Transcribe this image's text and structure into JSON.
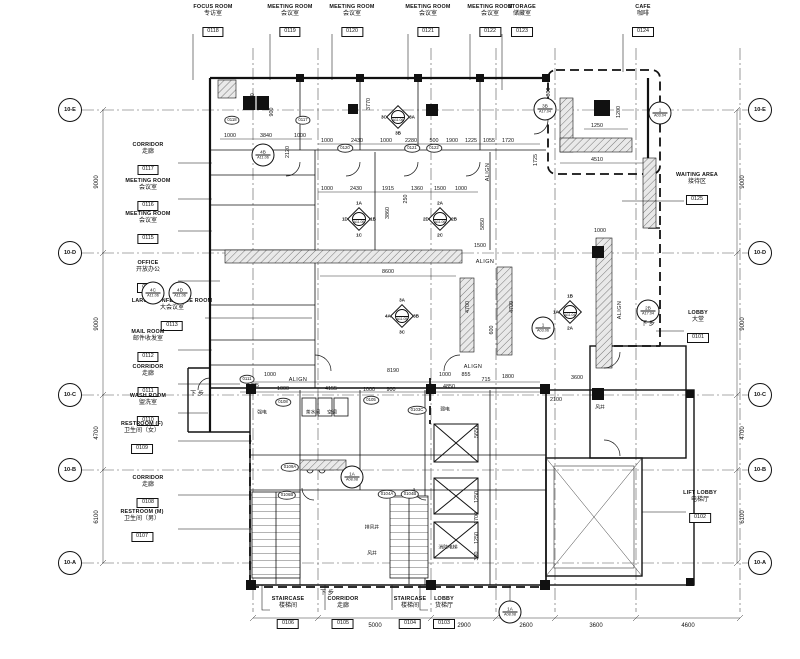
{
  "drawing": {
    "type": "architectural-floor-plan"
  },
  "grid": {
    "markers": [
      "10-E",
      "10-D",
      "10-C",
      "10-B",
      "10-A"
    ],
    "side_dims": [
      "9000",
      "9000",
      "4700",
      "6100"
    ],
    "bottom_dims": [
      "2900",
      "5000",
      "2900",
      "2600",
      "3600",
      "4600"
    ]
  },
  "rooms": {
    "top": [
      {
        "en": "FOCUS ROOM",
        "cn": "专访室",
        "num": "0118"
      },
      {
        "en": "MEETING ROOM",
        "cn": "会议室",
        "num": "0119"
      },
      {
        "en": "MEETING ROOM",
        "cn": "会议室",
        "num": "0120"
      },
      {
        "en": "MEETING ROOM",
        "cn": "会议室",
        "num": "0121"
      },
      {
        "en": "MEETING ROOM",
        "cn": "会议室",
        "num": "0122"
      },
      {
        "en": "STORAGE",
        "cn": "储藏室",
        "num": "0123"
      },
      {
        "en": "CAFE",
        "cn": "咖啡",
        "num": "0124"
      }
    ],
    "left": [
      {
        "en": "CORRIDOR",
        "cn": "走廊",
        "num": "0117"
      },
      {
        "en": "MEETING ROOM",
        "cn": "会议室",
        "num": "0116"
      },
      {
        "en": "MEETING ROOM",
        "cn": "会议室",
        "num": "0115"
      },
      {
        "en": "OFFICE",
        "cn": "开放办公",
        "num": "0114"
      },
      {
        "en": "LARGE CONFERENCE ROOM",
        "cn": "大会议室",
        "num": "0113"
      },
      {
        "en": "MAIL ROOM",
        "cn": "邮件收发室",
        "num": "0112"
      },
      {
        "en": "CORRIDOR",
        "cn": "走廊",
        "num": "0111"
      },
      {
        "en": "WASH ROOM",
        "cn": "盥洗室",
        "num": "0110"
      },
      {
        "en": "RESTROOM (F)",
        "cn": "卫生间（女）",
        "num": "0109"
      },
      {
        "en": "CORRIDOR",
        "cn": "走廊",
        "num": "0108"
      },
      {
        "en": "RESTROOM (M)",
        "cn": "卫生间（男）",
        "num": "0107"
      }
    ],
    "right": [
      {
        "en": "WAITING AREA",
        "cn": "接待区",
        "num": "0125"
      },
      {
        "en": "LOBBY",
        "cn": "大堂",
        "num": "0101"
      },
      {
        "en": "LIFT LOBBY",
        "cn": "电梯厅",
        "num": "0102"
      }
    ],
    "bottom": [
      {
        "en": "STAIRCASE",
        "cn": "楼梯间",
        "num": "0106"
      },
      {
        "en": "CORRIDOR",
        "cn": "走廊",
        "num": "0105"
      },
      {
        "en": "STAIRCASE",
        "cn": "楼梯间",
        "num": "0104"
      },
      {
        "en": "LOBBY",
        "cn": "货梯厅",
        "num": "0103"
      }
    ]
  },
  "dims": {
    "vals": [
      "1000",
      "3840",
      "1000",
      "1000",
      "2430",
      "1000",
      "2280",
      "500",
      "1900",
      "1225",
      "1055",
      "1720",
      "1000",
      "2430",
      "1915",
      "1360",
      "1500",
      "1000",
      "250",
      "8600",
      "1000",
      "8190",
      "1000",
      "855",
      "715",
      "1800",
      "1475",
      "1000",
      "4155",
      "1000",
      "900",
      "4850",
      "1250",
      "1200",
      "4510",
      "1000",
      "800",
      "1150",
      "900",
      "2120",
      "3770",
      "3860",
      "4700",
      "4700",
      "600",
      "5850",
      "1725",
      "1500",
      "2100",
      "3600",
      "5650",
      "1250",
      "1700",
      "1250",
      "350"
    ]
  },
  "markers": {
    "diamonds": [
      {
        "n": "",
        "e": "3A",
        "s": "3B",
        "w": "3C",
        "ref": "A11.06"
      },
      {
        "n": "1A",
        "e": "1B",
        "s": "1C",
        "w": "1D",
        "ref": "A11.06"
      },
      {
        "n": "2A",
        "e": "2B",
        "s": "2C",
        "w": "2D",
        "ref": "A11.06"
      },
      {
        "n": "3A",
        "e": "3B",
        "s": "3C",
        "w": "4A",
        "ref": "A11.05"
      },
      {
        "n": "1B",
        "e": "",
        "s": "2A",
        "w": "1A",
        "ref": "A11.04"
      }
    ],
    "circles": [
      {
        "t": "4B",
        "ref": "A11.06"
      },
      {
        "t": "4C",
        "ref": "A11.06"
      },
      {
        "t": "4D",
        "ref": "A11.06"
      },
      {
        "t": "3B",
        "ref": "A17.04"
      },
      {
        "t": "1",
        "ref": "A03.04"
      },
      {
        "t": "2B",
        "ref": "A17.04"
      },
      {
        "t": "1",
        "ref": "A03.06"
      },
      {
        "t": "1A",
        "ref": "A08.08"
      },
      {
        "t": "1A",
        "ref": "A08.08"
      }
    ]
  },
  "door_tags": [
    "0118",
    "0117",
    "0120",
    "0121",
    "0122",
    "0111",
    "0105",
    "0108",
    "0106B",
    "0104A",
    "0104B",
    "0103C",
    "0109A"
  ],
  "annotations": {
    "align": "ALIGN",
    "down": "下 步",
    "interior": [
      "强电",
      "茶水间",
      "空调",
      "弱电",
      "排风井",
      "风井",
      "风井",
      "消防电梯"
    ]
  }
}
